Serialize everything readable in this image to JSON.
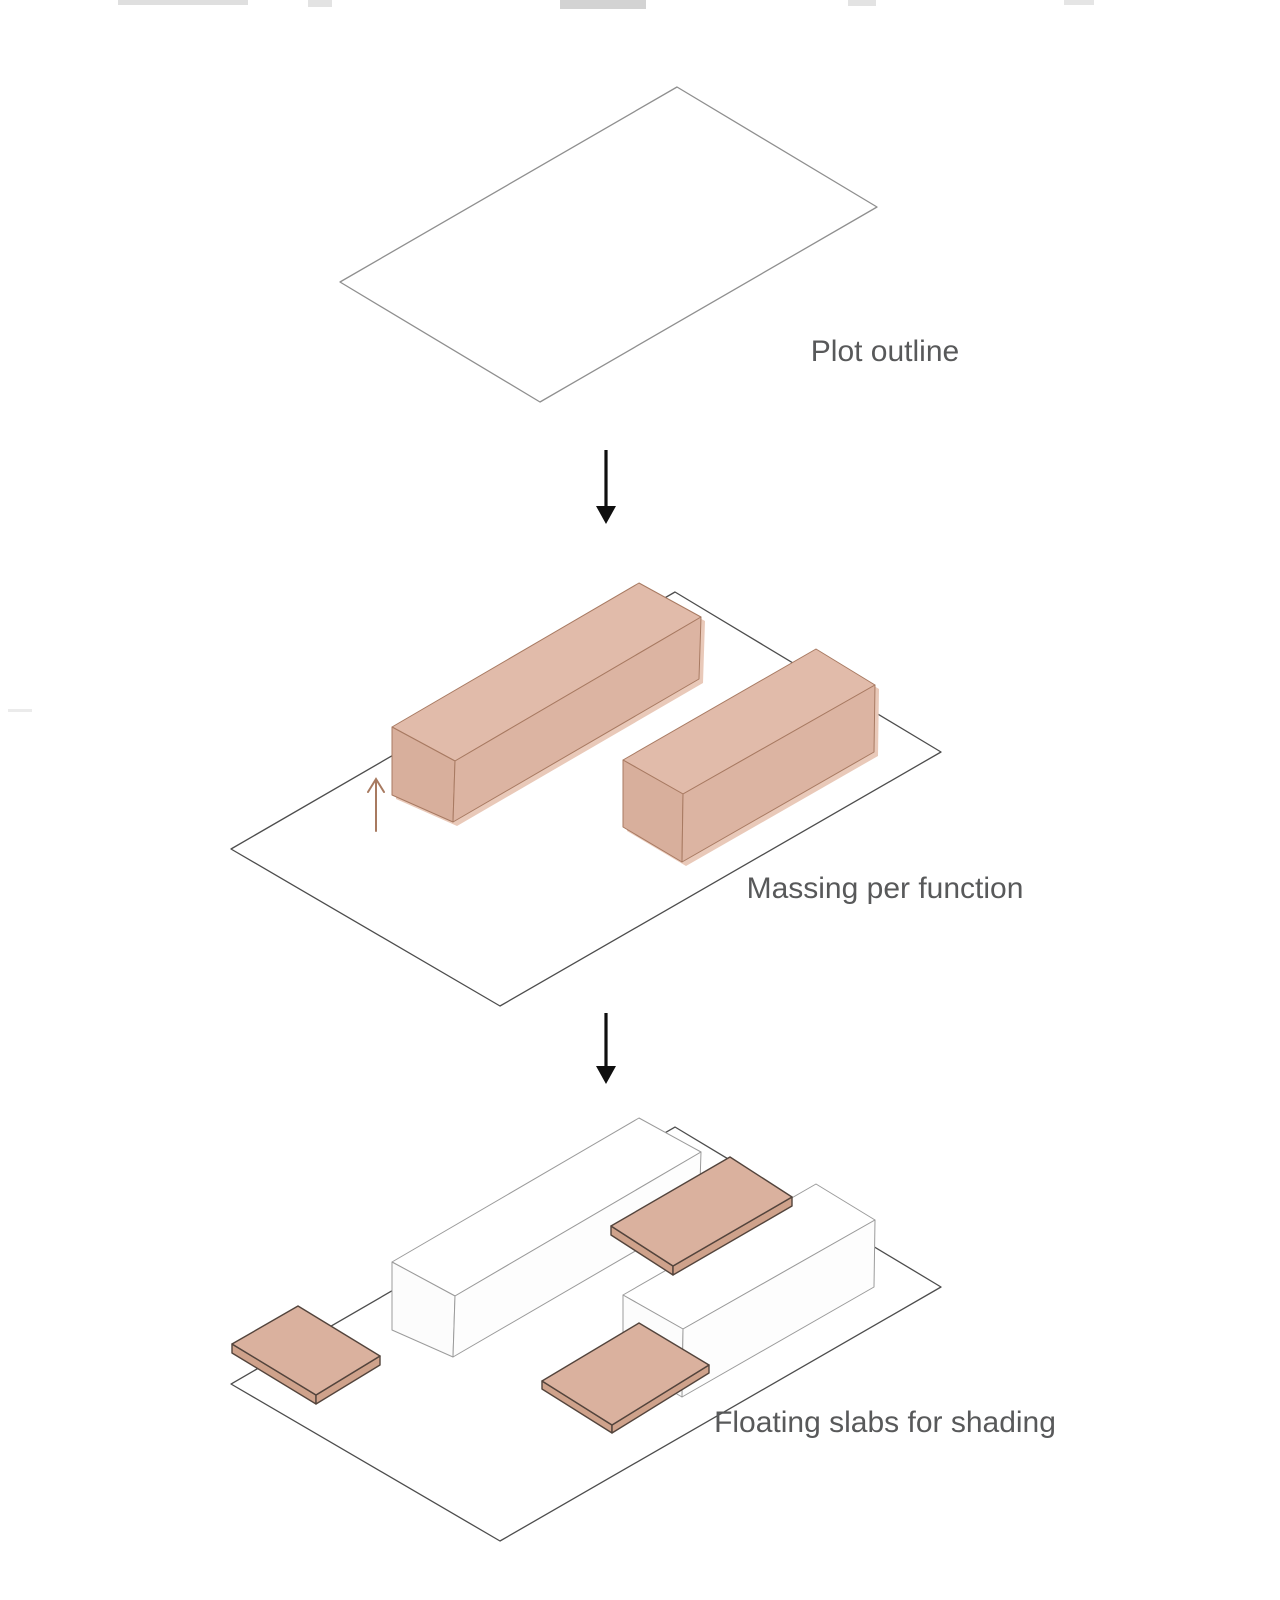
{
  "diagram": {
    "title": "Architectural massing concept diagram",
    "steps": [
      {
        "id": "plot-outline",
        "label": "Plot outline"
      },
      {
        "id": "massing-per-function",
        "label": "Massing per function"
      },
      {
        "id": "floating-slabs",
        "label": "Floating slabs for shading"
      }
    ],
    "icons": {
      "flow_arrow_1": "down-arrow",
      "flow_arrow_2": "down-arrow",
      "extrude_arrow": "up-arrow"
    },
    "colors": {
      "background": "#ffffff",
      "plot_stroke_top": "#8f8f8f",
      "plot_stroke": "#4d4d4d",
      "mass_top_face": "#e1bbaa",
      "mass_front_face": "#dcb4a2",
      "mass_end_face": "#d8af9c",
      "mass_edge": "#a87a62",
      "mass_shadow": "#e9c9b9",
      "white_box_fill": "#ffffff",
      "white_box_stroke": "#9b9b9b",
      "slab_top": "#dab19e",
      "slab_side": "#cfa28b",
      "slab_edge": "#53443c",
      "flow_arrow": "#0f0f0f",
      "extrude_arrow": "#a87a60",
      "label_text": "#58595a"
    }
  }
}
